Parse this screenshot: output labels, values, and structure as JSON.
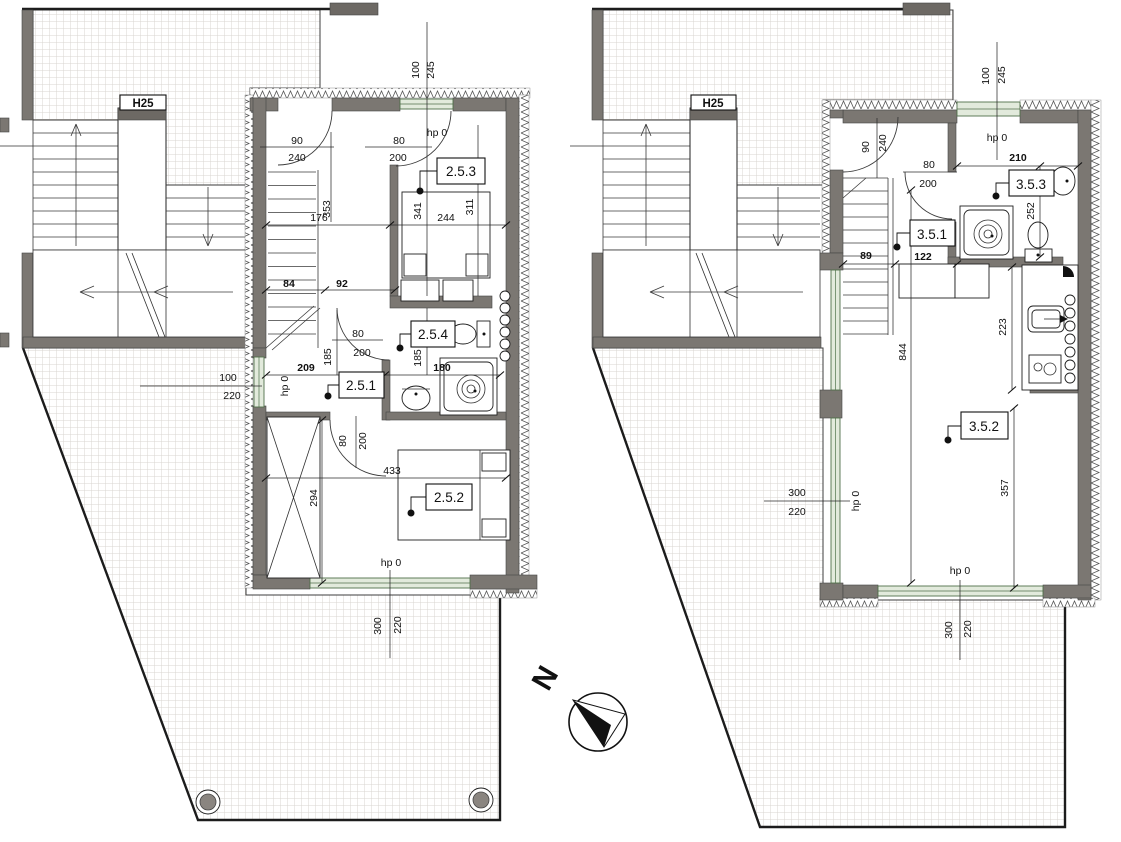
{
  "meta": {
    "drawing_type": "architectural floor plan",
    "sheets": 2
  },
  "palette": {
    "wall": "#7b7772",
    "wall_dark": "#6d6964",
    "window_fill": "#e2eadc",
    "window_stroke": "#50714b",
    "grid_line": "#d9d5d0",
    "line": "#1f1f1f"
  },
  "compass": {
    "label": "N"
  },
  "left": {
    "elevator": "H25",
    "room1": "2.5.1",
    "room2": "2.5.2",
    "room3": "2.5.3",
    "room4": "2.5.4",
    "win_top_w": "100",
    "win_top_h": "245",
    "hp_top": "hp 0",
    "door_entry_w": "90",
    "door_entry_h": "240",
    "door_253_w": "80",
    "door_253_h": "200",
    "d341": "341",
    "d311": "311",
    "d244": "244",
    "d176": "176",
    "d353": "353",
    "d84": "84",
    "d92": "92",
    "door_254_w": "80",
    "door_254_h": "200",
    "d185a": "185",
    "d185b": "185",
    "d180": "180",
    "d209": "209",
    "hp_left": "hp 0",
    "win_left_w": "100",
    "win_left_h": "220",
    "door_252_w": "80",
    "door_252_h": "200",
    "d433": "433",
    "d294": "294",
    "hp_bottom": "hp 0",
    "win_bottom_w": "300",
    "win_bottom_h": "220"
  },
  "right": {
    "elevator": "H25",
    "room1": "3.5.1",
    "room2": "3.5.2",
    "room3": "3.5.3",
    "win_top_w": "100",
    "win_top_h": "245",
    "hp_top": "hp 0",
    "door_entry_w": "90",
    "door_entry_h": "240",
    "d210": "210",
    "door_353_w": "80",
    "door_353_h": "200",
    "d252": "252",
    "d89": "89",
    "d122": "122",
    "d844": "844",
    "d223": "223",
    "d357": "357",
    "hp_left": "hp 0",
    "win_left_w": "300",
    "win_left_h": "220",
    "hp_bottom": "hp 0",
    "win_bottom_w": "300",
    "win_bottom_h": "220"
  }
}
